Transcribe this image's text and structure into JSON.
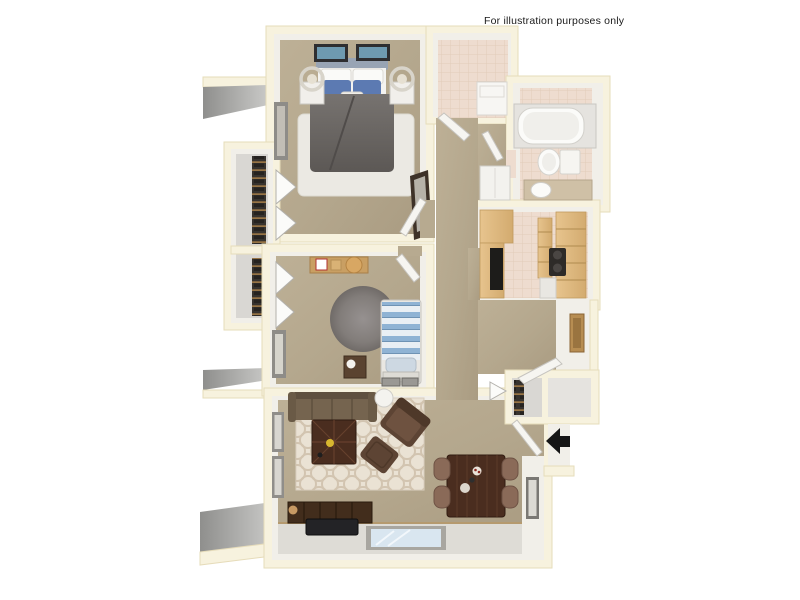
{
  "disclaimer": "For illustration purposes only",
  "icons": {
    "entry_arrow": "left-block-arrow"
  },
  "palette": {
    "background": "#ffffff",
    "wall_cream": "#f7f2de",
    "wall_face": "#f1efe9",
    "carpet_tan": "#b7aa90",
    "tile_pink": "#eedccf",
    "closet_floor_gray": "#d9d7d3",
    "exterior_ledge_gray": "#a5a5a3",
    "wood_cabinet": "#e0bd87",
    "sofa_brown": "#75644f",
    "armchair_brown": "#5d4434",
    "table_wood_dark": "#4a2d1f",
    "dining_chair": "#8a6a58",
    "tv_console": "#422d1c",
    "duvet_gray": "#6a6663",
    "bed_pillow_blue": "#5c7ab2",
    "bed2_stripe_blue": "#8fb3d4",
    "area_rug_white": "#ebe9e3",
    "trellis_rug": "#eae2d4",
    "round_rug_gray": "#878280",
    "window_glass": "#d9e6f0",
    "arrow_black": "#151515"
  }
}
